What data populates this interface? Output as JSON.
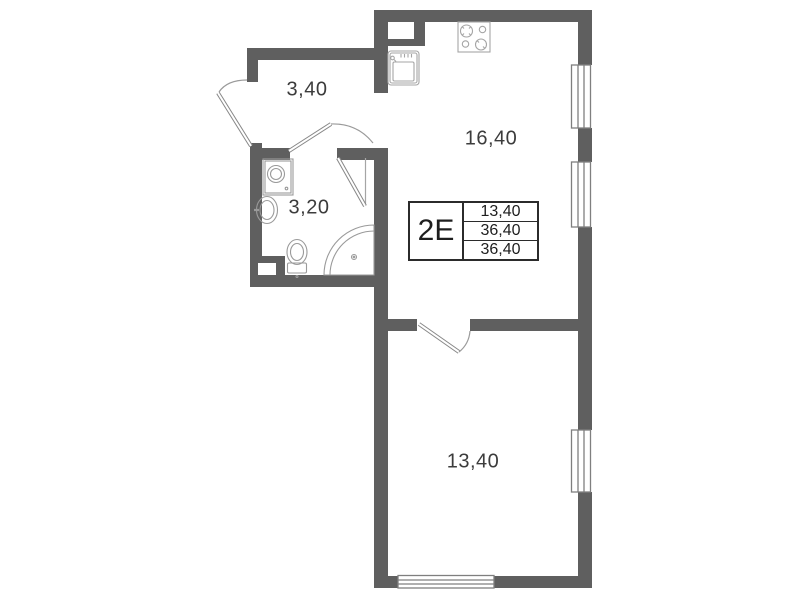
{
  "plan": {
    "unit": {
      "code": "2E",
      "values": [
        "13,40",
        "36,40",
        "36,40"
      ]
    },
    "rooms": {
      "hall": {
        "area": "3,40"
      },
      "bathroom": {
        "area": "3,20"
      },
      "kitchen_living": {
        "area": "16,40"
      },
      "bedroom": {
        "area": "13,40"
      }
    },
    "colors": {
      "wall": "#5f5f5f",
      "thin_line": "#9a9a9a",
      "text": "#3c3c3c",
      "table_border": "#2b2b2b"
    }
  }
}
